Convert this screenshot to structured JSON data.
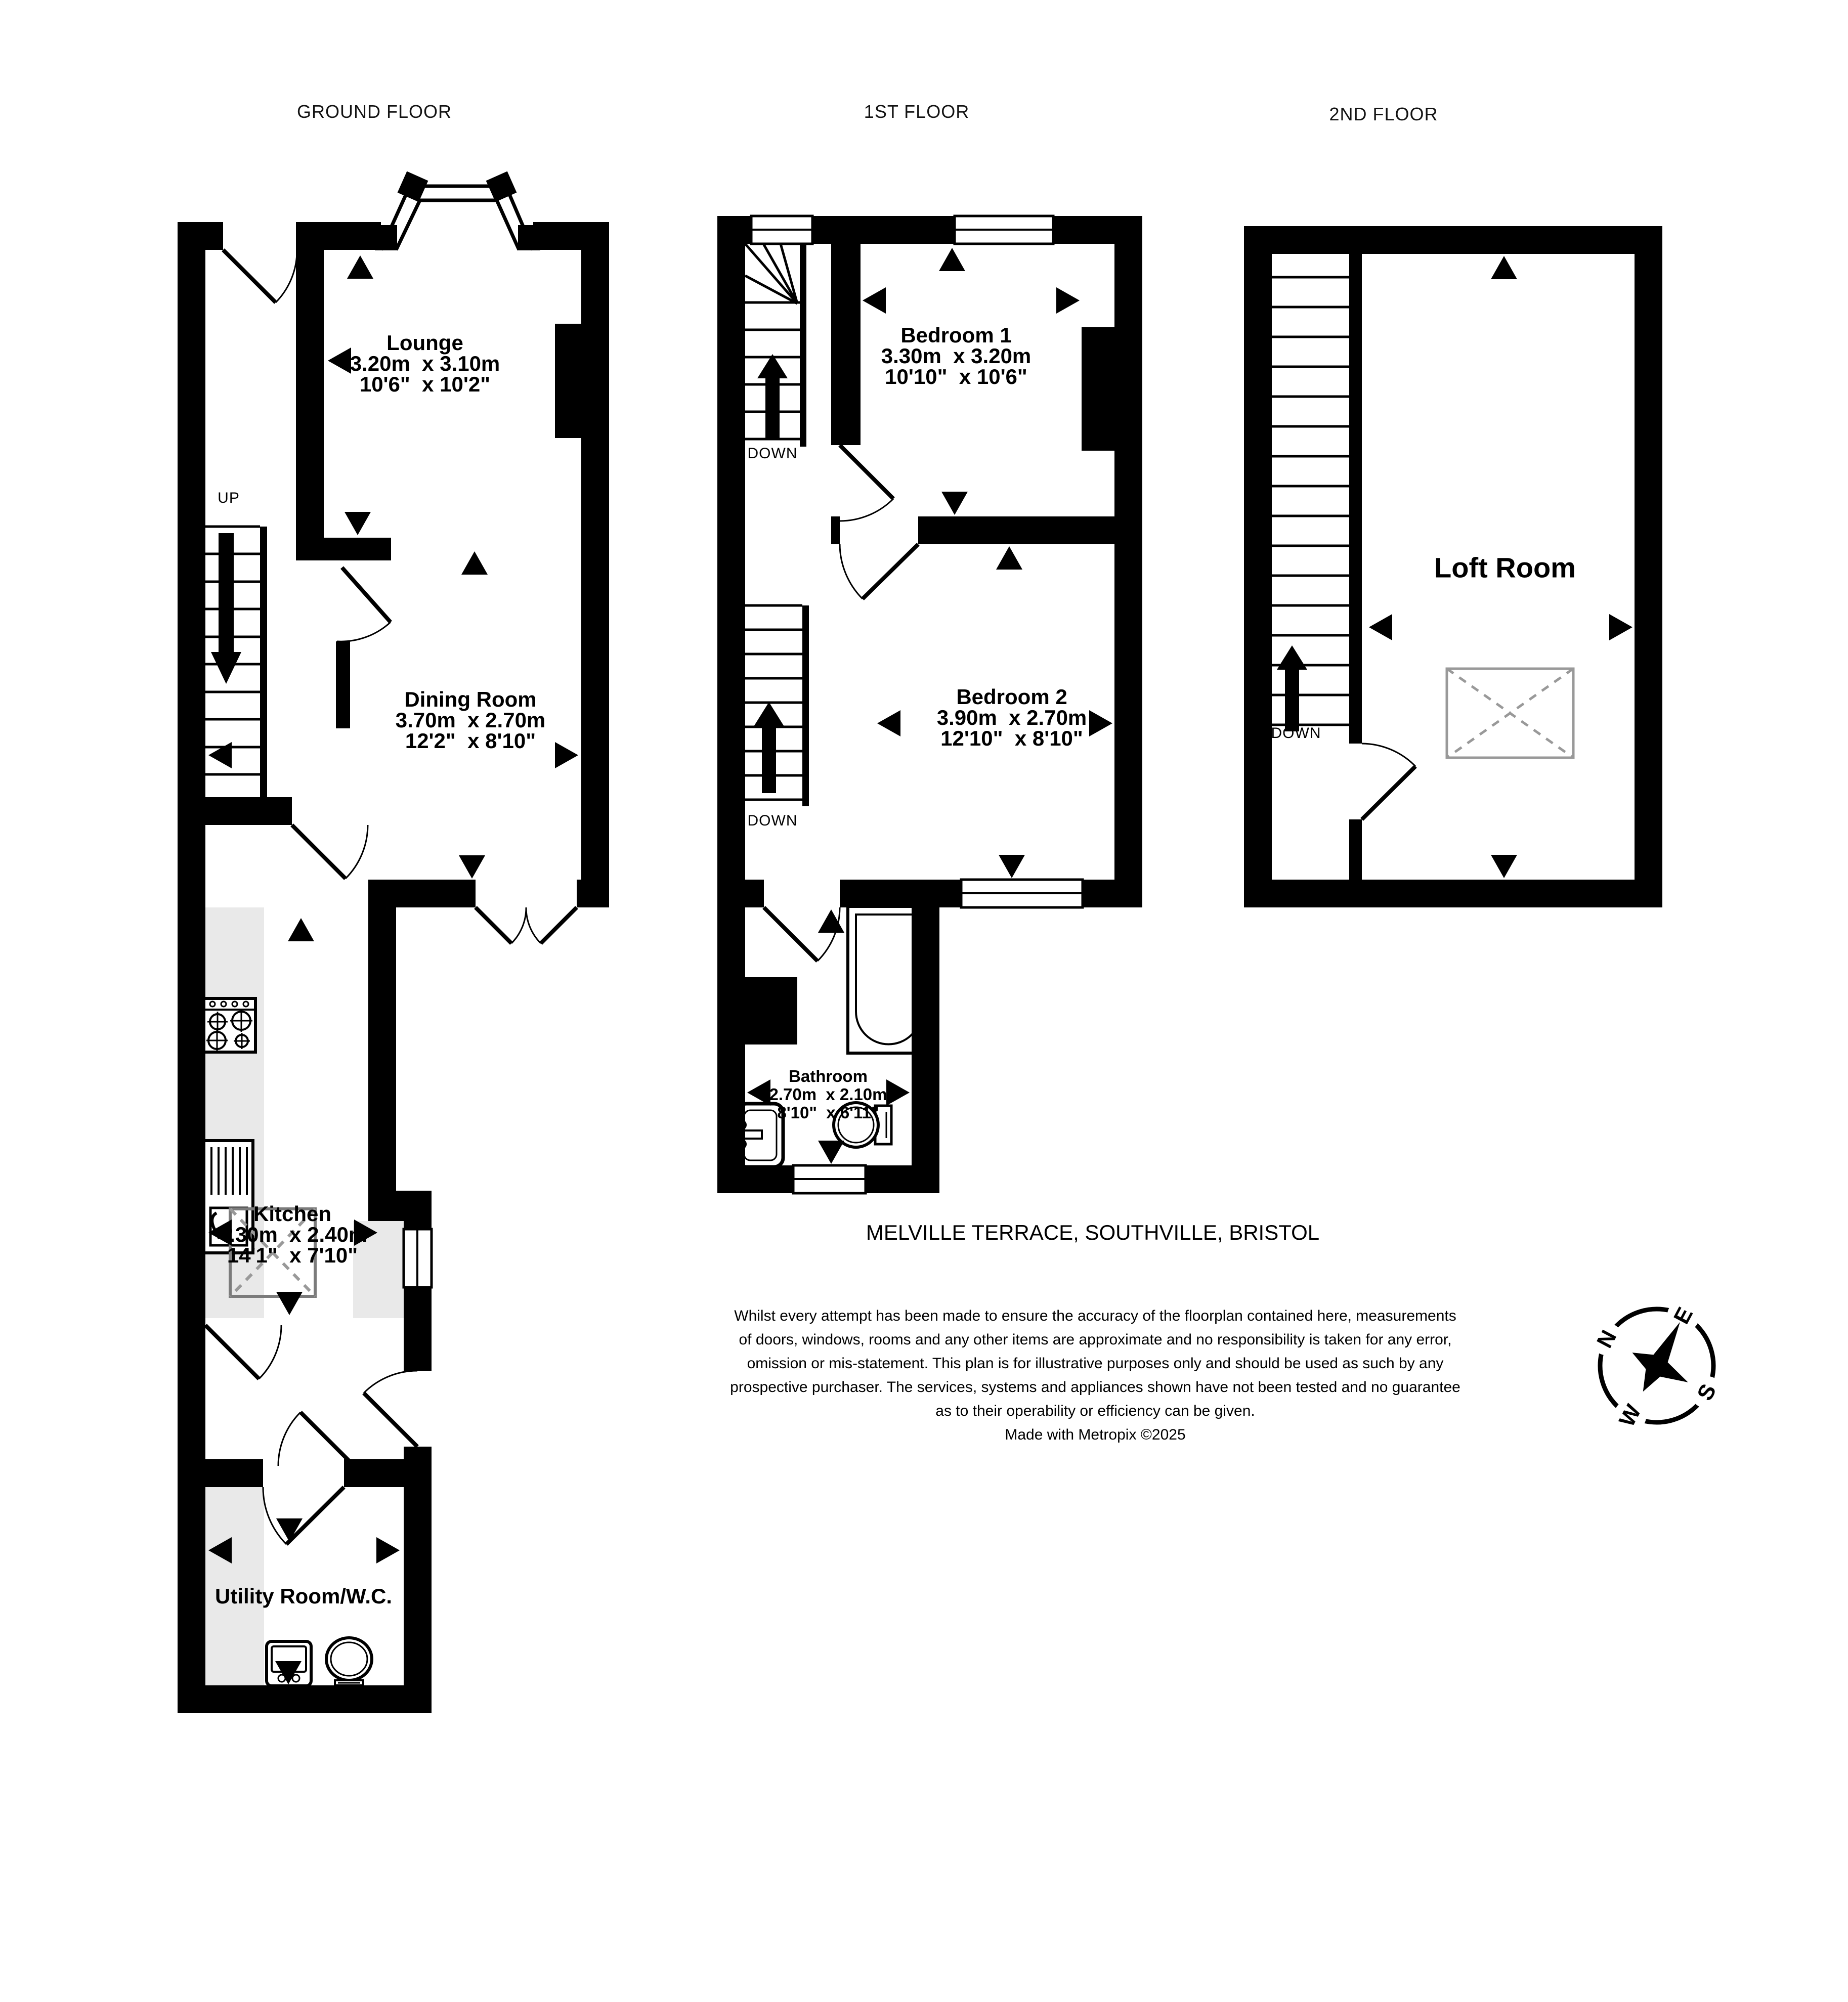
{
  "floors": {
    "ground": {
      "title": "GROUND FLOOR"
    },
    "first": {
      "title": "1ST FLOOR"
    },
    "second": {
      "title": "2ND FLOOR"
    }
  },
  "rooms": {
    "lounge": {
      "name": "Lounge",
      "metric": "3.20m  x 3.10m",
      "imperial": "10'6\"  x 10'2\""
    },
    "dining": {
      "name": "Dining Room",
      "metric": "3.70m  x 2.70m",
      "imperial": "12'2\"  x 8'10\""
    },
    "kitchen": {
      "name": "Kitchen",
      "metric": "4.30m  x 2.40m",
      "imperial": "14'1\"  x 7'10\""
    },
    "utility": {
      "name": "Utility Room/W.C."
    },
    "bedroom1": {
      "name": "Bedroom 1",
      "metric": "3.30m  x 3.20m",
      "imperial": "10'10\"  x 10'6\""
    },
    "bedroom2": {
      "name": "Bedroom 2",
      "metric": "3.90m  x 2.70m",
      "imperial": "12'10\"  x 8'10\""
    },
    "bathroom": {
      "name": "Bathroom",
      "metric": "2.70m  x 2.10m",
      "imperial": "8'10\"  x 6'11\""
    },
    "loft": {
      "name": "Loft Room"
    }
  },
  "stairs": {
    "up_label": "UP",
    "down_label": "DOWN"
  },
  "address": "MELVILLE TERRACE, SOUTHVILLE, BRISTOL",
  "disclaimer": {
    "lines": [
      "Whilst every attempt has been made to ensure the accuracy of the floorplan contained here, measurements",
      "of doors, windows, rooms and any other items are approximate and no responsibility is taken for any error,",
      "omission or mis-statement. This plan is for illustrative purposes only and should be used as such by any",
      "prospective purchaser. The services, systems and appliances shown have not been tested and no guarantee",
      "as to their operability or efficiency can be given.",
      "Made with Metropix ©2025"
    ]
  },
  "compass": {
    "n": "N",
    "e": "E",
    "s": "S",
    "w": "W"
  },
  "colors": {
    "wall": "#000000",
    "counter": "#e9e9e9",
    "dashed_gray": "#999999",
    "table_gray": "#7b7b7b"
  },
  "icons": [
    "hob-icon",
    "kitchen-sink-icon",
    "washing-machine-icon",
    "toilet-icon",
    "bath-icon",
    "basin-icon",
    "compass-rose-icon",
    "dimension-arrow-icon",
    "door-swing-icon",
    "stairs-icon",
    "window-icon",
    "bay-window-icon"
  ]
}
